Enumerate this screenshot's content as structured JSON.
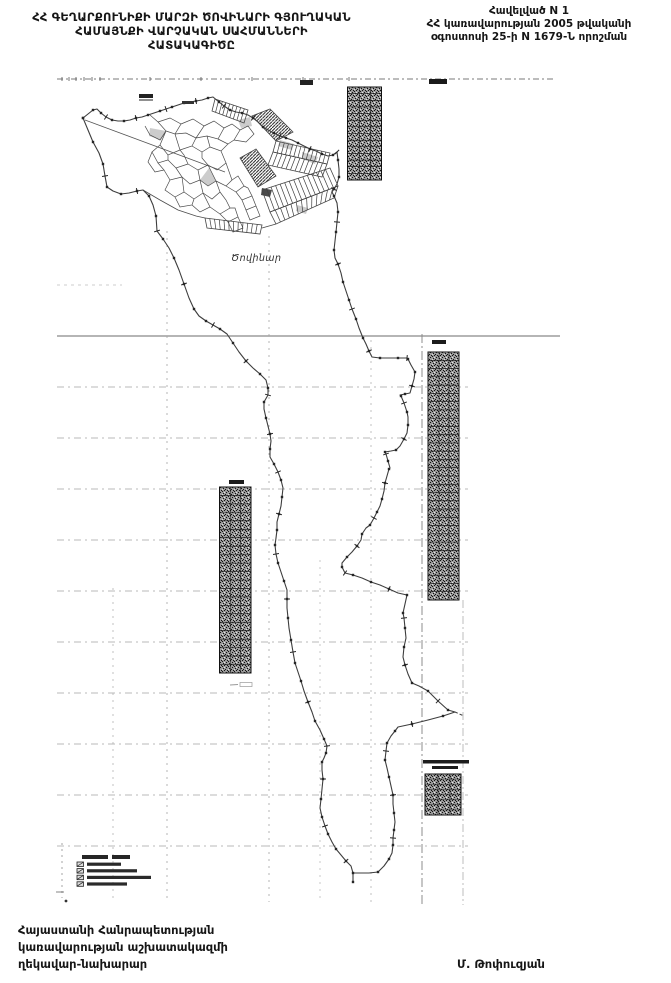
{
  "document": {
    "title_lines": [
      "ՀՀ ԳԵՂԱՐՔՈՒՆԻՔԻ ՄԱՐԶԻ ԾՈՎԻՆԱՐԻ ԳՅՈՒՂԱԿԱՆ",
      "ՀԱՄԱՅՆՔԻ ՎԱՐՉԱԿԱՆ   ՍԱՀՄԱՆՆԵՐԻ",
      "ՀԱՏԱԿԱԳԻԾԸ"
    ],
    "annex_lines": [
      "Հավելված N 1",
      "ՀՀ կառավարության 2005 թվականի",
      "օգոստոսի 25-ի N 1679-Ն որոշման"
    ],
    "footer_lines": [
      "Հայաստանի Հանրապետության",
      "կառավարության աշխատակազմի",
      "ղեկավար-նախարար"
    ],
    "signature": "Մ. Թոփուզյան"
  },
  "map": {
    "settlement_label": "Ծովինար",
    "coordinate_tables": [
      {
        "id": "A",
        "position": "top-right",
        "rows": 14,
        "cols": 3,
        "legible": false
      },
      {
        "id": "B",
        "position": "right-middle",
        "rows": 30,
        "cols": 3,
        "legible": false
      },
      {
        "id": "C",
        "position": "left-middle",
        "rows": 22,
        "cols": 3,
        "legible": false
      },
      {
        "id": "D",
        "position": "bottom-right",
        "rows": 8,
        "cols": 3,
        "legible": false,
        "header_lines": 2
      }
    ],
    "legend": {
      "position": "bottom-left",
      "title_legible": false,
      "item_count": 4
    }
  },
  "colors": {
    "paper": "#ffffff",
    "ink": "#161616",
    "boundary": "#3d3d3d",
    "grid": "#a3a3a3",
    "table_fill": "#9a9a9a"
  }
}
